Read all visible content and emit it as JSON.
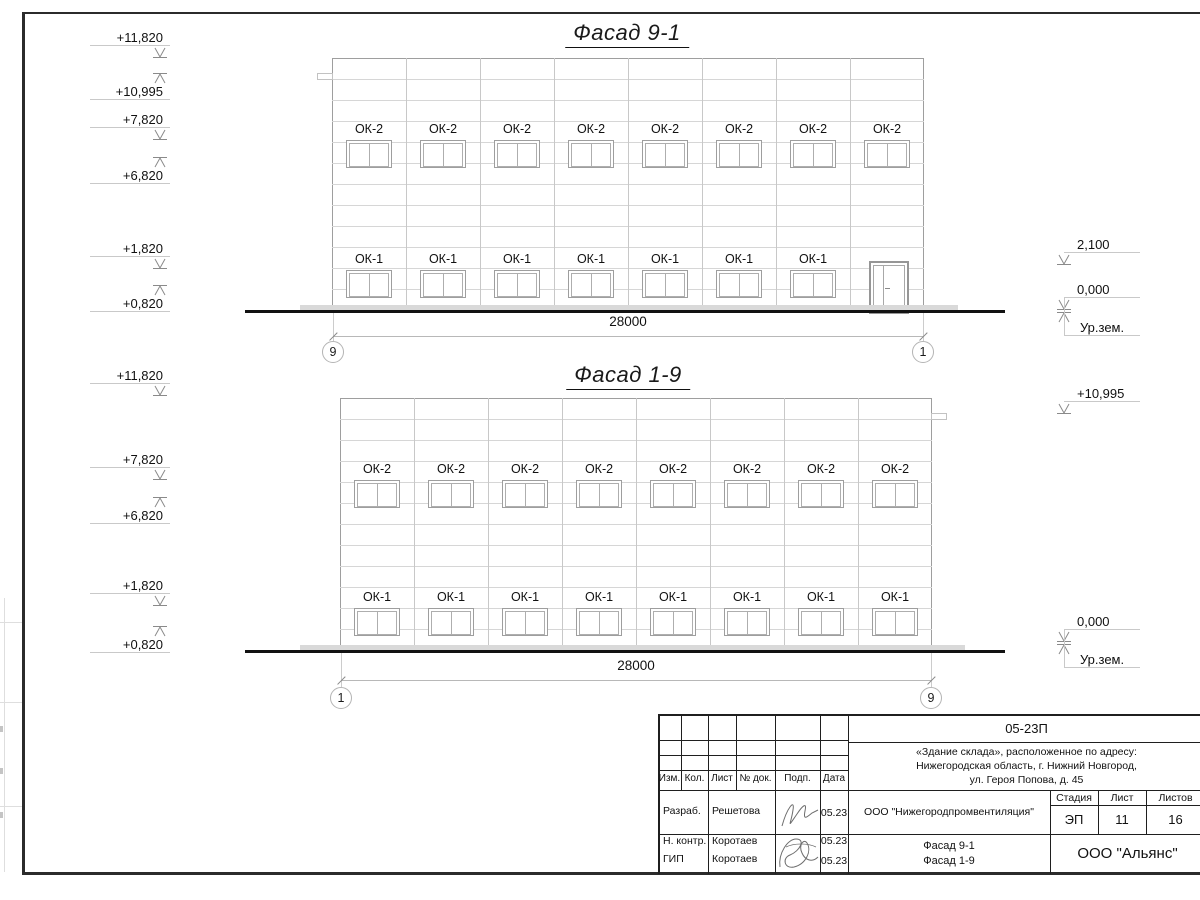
{
  "sheet": {
    "background": "#ffffff",
    "line_color": "#1a1a1a"
  },
  "facades": [
    {
      "title": "Фасад 9-1",
      "window_top_label": "ОК-2",
      "window_top_count": 8,
      "window_bottom_label": "ОК-1",
      "window_bottom_count": 7,
      "has_door": true,
      "dimension": "28000",
      "axis_left": "9",
      "axis_right": "1",
      "left_marks": [
        {
          "text": "+11,820",
          "dir": "down"
        },
        {
          "text": "+10,995",
          "dir": "up"
        },
        {
          "text": "+7,820",
          "dir": "down"
        },
        {
          "text": "+6,820",
          "dir": "up"
        },
        {
          "text": "+1,820",
          "dir": "down"
        },
        {
          "text": "+0,820",
          "dir": "up"
        }
      ],
      "right_marks": [
        {
          "text": "2,100",
          "dir": "down"
        },
        {
          "text": "0,000",
          "dir": "ground",
          "ground_label": "Ур.зем."
        }
      ]
    },
    {
      "title": "Фасад 1-9",
      "window_top_label": "ОК-2",
      "window_top_count": 8,
      "window_bottom_label": "ОК-1",
      "window_bottom_count": 8,
      "has_door": false,
      "dimension": "28000",
      "axis_left": "1",
      "axis_right": "9",
      "left_marks": [
        {
          "text": "+11,820",
          "dir": "down"
        },
        {
          "text": "+7,820",
          "dir": "down"
        },
        {
          "text": "+6,820",
          "dir": "up"
        },
        {
          "text": "+1,820",
          "dir": "down"
        },
        {
          "text": "+0,820",
          "dir": "up"
        }
      ],
      "right_marks": [
        {
          "text": "+10,995",
          "dir": "down"
        },
        {
          "text": "0,000",
          "dir": "ground",
          "ground_label": "Ур.зем."
        }
      ]
    }
  ],
  "title_block": {
    "doc_number": "05-23П",
    "address_lines": [
      "«Здание склада», расположенное по адресу:",
      "Нижегородская область, г. Нижний Новгород,",
      "ул. Героя Попова, д. 45"
    ],
    "columns": [
      "Изм.",
      "Кол.",
      "Лист",
      "№ док.",
      "Подп.",
      "Дата"
    ],
    "rows": [
      {
        "role": "Разраб.",
        "name": "Решетова",
        "date": "05.23"
      },
      {
        "role": "Н. контр.",
        "name": "Коротаев",
        "date": "05.23"
      },
      {
        "role": "ГИП",
        "name": "Коротаев",
        "date": "05.23"
      }
    ],
    "org": "ООО \"Нижегородпромвентиляция\"",
    "stage_label": "Стадия",
    "sheet_label": "Лист",
    "sheets_label": "Листов",
    "stage": "ЭП",
    "sheet_no": "11",
    "sheets_total": "16",
    "content_lines": [
      "Фасад 9-1",
      "Фасад 1-9"
    ],
    "company": "ООО \"Альянс\""
  }
}
